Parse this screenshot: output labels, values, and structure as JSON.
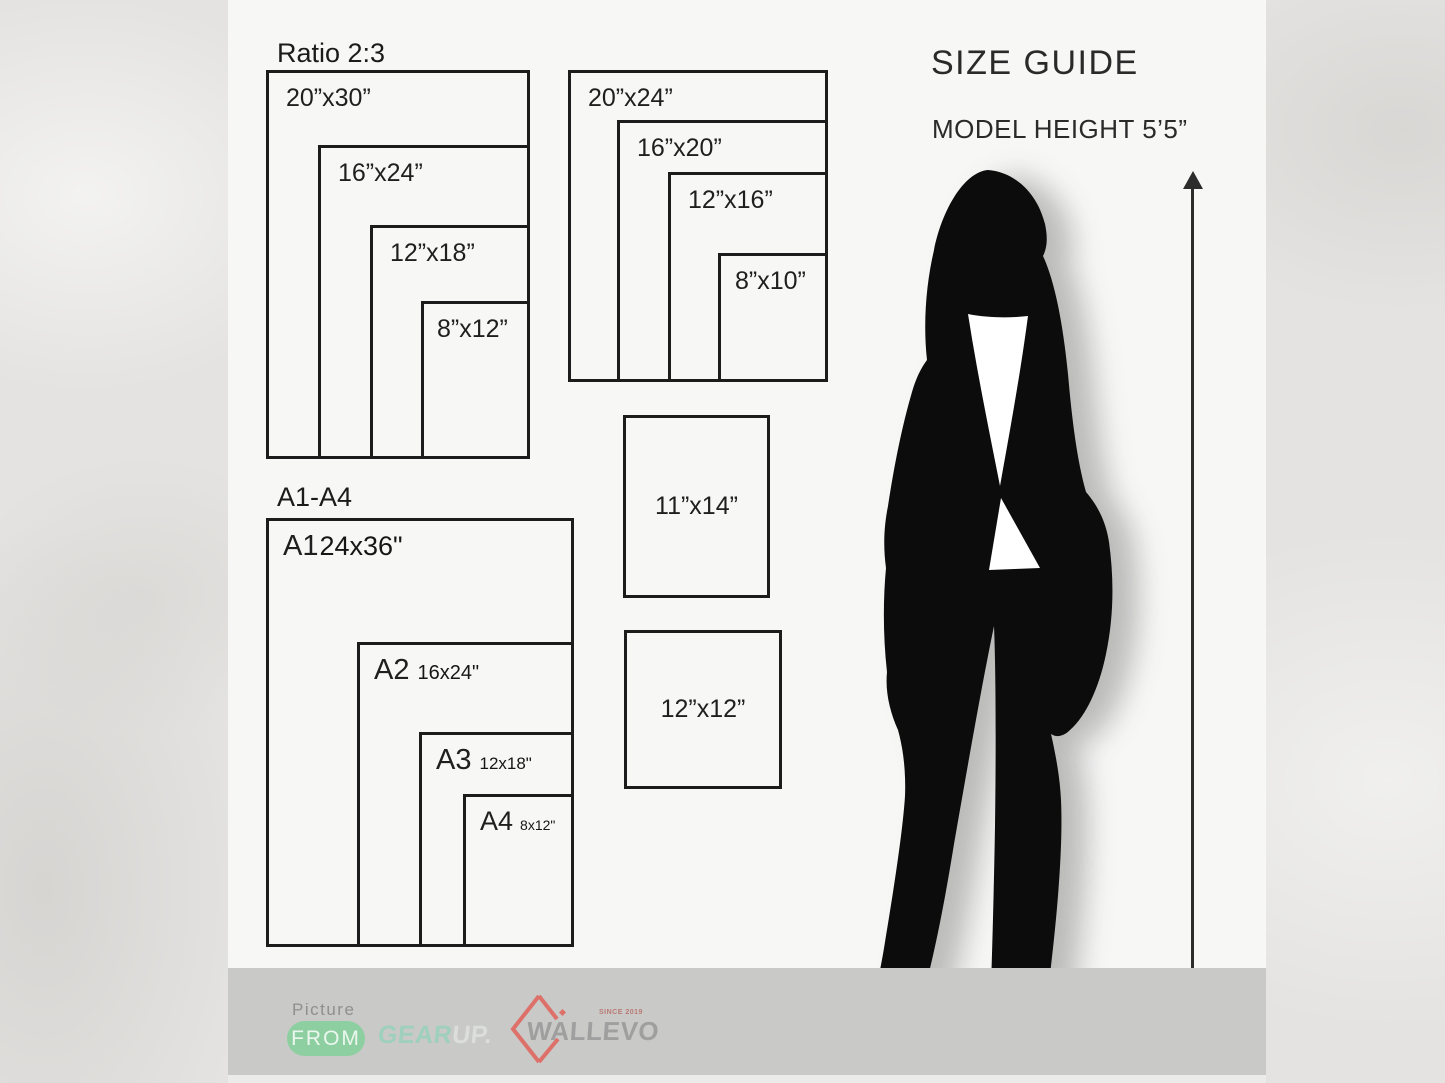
{
  "page": {
    "title": "SIZE GUIDE",
    "model_height": "MODEL HEIGHT 5’5”"
  },
  "ratio_group": {
    "heading": "Ratio 2:3",
    "sizes": [
      "20”x30”",
      "16”x24”",
      "12”x18”",
      "8”x12”"
    ]
  },
  "standard_group": {
    "sizes": [
      "20”x24”",
      "16”x20”",
      "12”x16”",
      "8”x10”"
    ]
  },
  "a_group": {
    "heading": "A1-A4",
    "items": [
      {
        "name": "A1",
        "dims": "24x36\""
      },
      {
        "name": "A2",
        "dims": "16x24\""
      },
      {
        "name": "A3",
        "dims": "12x18\""
      },
      {
        "name": "A4",
        "dims": "8x12\""
      }
    ]
  },
  "singles": {
    "s1": "11”x14”",
    "s2": "12”x12”"
  },
  "footer": {
    "picture": "Picture",
    "from": "FROM",
    "gear": "GEAR",
    "up": "UP.",
    "brand": "WALLEVO",
    "since": "SINCE 2019"
  },
  "colors": {
    "pill_green": "#8ecfa1",
    "mint": "#9ed0bd",
    "coral": "#dd7069",
    "bar_gray": "#c9c9c8",
    "panel": "#f7f7f6",
    "ink": "#1c1c1c"
  }
}
